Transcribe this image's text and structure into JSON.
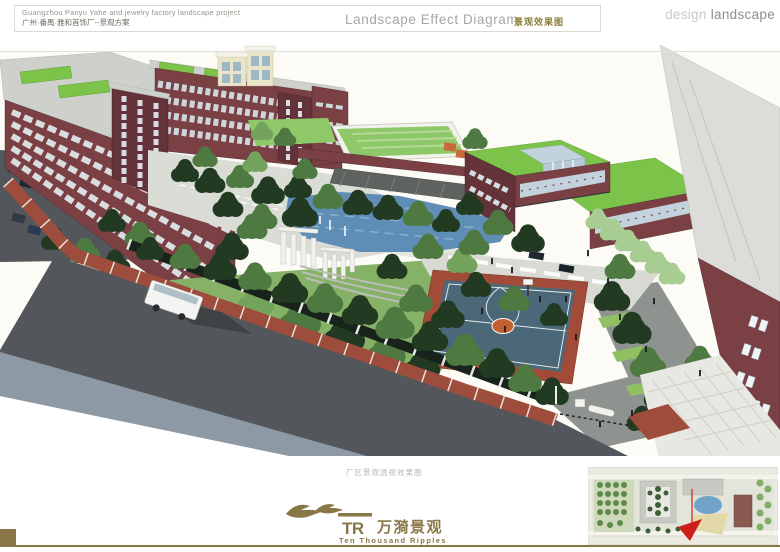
{
  "header": {
    "project_title_en": "Guangzhou Panyu Yahe and jewelry factory landscape project",
    "project_title_cn": "广州·番禺·雅和首饰厂--景观方案",
    "sheet_title_en": "Landscape Effect Diagram",
    "sheet_title_cn": "景观效果图",
    "brand_light": "design",
    "brand_dark": "landscape"
  },
  "main": {
    "caption": "厂区景观透视效果图"
  },
  "footer": {
    "logo_monogram": "TR",
    "logo_cn": "万漪景观",
    "logo_en": "Ten Thousand Ripples"
  },
  "theme": {
    "gold": "#8a7747",
    "title_gray": "#a6a6a1",
    "header_text": "#9a968c",
    "header_cn": "#6f6b60",
    "brand_light": "#c8c8c4",
    "brand_dark": "#8e8e89",
    "cn_olive": "#8a7d3a",
    "caption_gray": "#a9a9a5",
    "sky": "#fcfbf6",
    "maroon": "#7a4044",
    "maroon_dark": "#64333a",
    "roof_gray": "#ced1cb",
    "roof_green": "#7cc34a",
    "lawn": "#8fc868",
    "water": "#5e8db5",
    "water_light": "#8db3d2",
    "road": "#53575b",
    "road_band": "#8d9aa6",
    "sidewalk": "#9e4c3c",
    "gravel": "#dadcd6",
    "paving": "#d8dad3",
    "court_blue": "#4a6878",
    "court_border": "#a14b38",
    "court_orange": "#c2602f",
    "glass": "#c2d3dd",
    "white_struct": "#f1f1ec",
    "fence_dark": "#17231b",
    "tree_dark": "#233a22",
    "tree_mid": "#4e7a42",
    "tree_light": "#74a35c",
    "tree_pale": "#a7cd92",
    "cream": "#eae4c8",
    "gray_slab": "#dcddd9",
    "shadow": "#3c4043"
  }
}
